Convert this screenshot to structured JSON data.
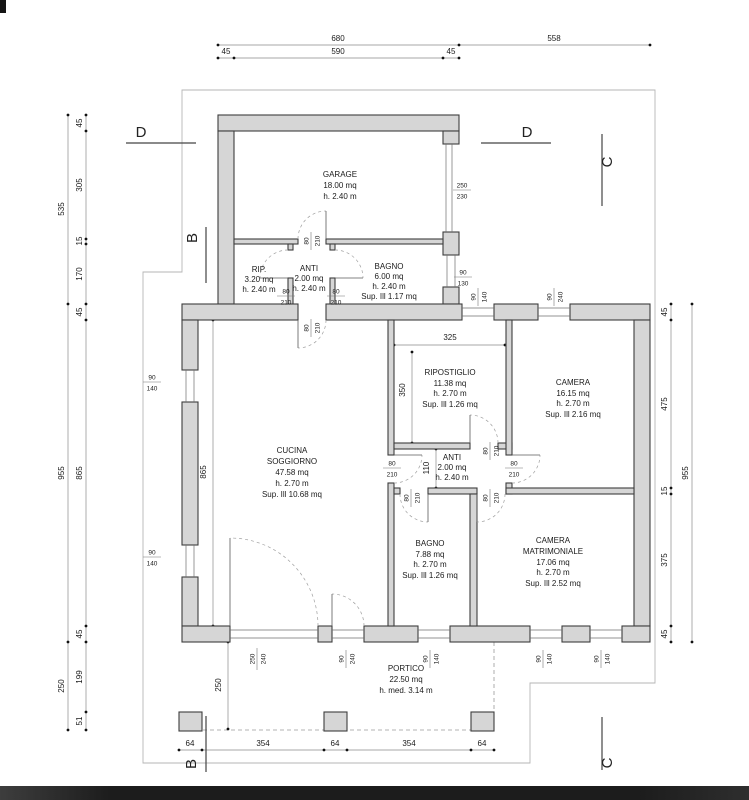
{
  "title": "Floor plan drawing",
  "colors": {
    "background": "#ffffff",
    "wall_fill": "#d6d6d6",
    "wall_stroke": "#3e3e3e",
    "dimension_line": "#8a8a8a",
    "footer_bar": "#1c1c1c"
  },
  "sections": {
    "d": "D",
    "b": "B",
    "c": "C"
  },
  "rooms": {
    "garage": [
      "GARAGE",
      "18.00 mq",
      "h. 2.40 m"
    ],
    "rip": [
      "RIP.",
      "3.20 mq",
      "h. 2.40 m"
    ],
    "anti_top": [
      "ANTI",
      "2.00 mq",
      "h. 2.40 m"
    ],
    "bagno_top": [
      "BAGNO",
      "6.00 mq",
      "h. 2.40 m",
      "Sup. Ill 1.17 mq"
    ],
    "ripostiglio": [
      "RIPOSTIGLIO",
      "11.38 mq",
      "h. 2.70 m",
      "Sup. Ill 1.26 mq"
    ],
    "camera": [
      "CAMERA",
      "16.15 mq",
      "h. 2.70 m",
      "Sup. Ill 2.16 mq"
    ],
    "cucina": [
      "CUCINA",
      "SOGGIORNO",
      "47.58 mq",
      "h. 2.70 m",
      "Sup. Ill 10.68 mq"
    ],
    "anti_mid": [
      "ANTI",
      "2.00 mq",
      "h. 2.40 m"
    ],
    "bagno": [
      "BAGNO",
      "7.88 mq",
      "h. 2.70 m",
      "Sup. Ill 1.26 mq"
    ],
    "camera_matrimoniale": [
      "CAMERA",
      "MATRIMONIALE",
      "17.06 mq",
      "h. 2.70 m",
      "Sup. Ill 2.52 mq"
    ],
    "portico": [
      "PORTICO",
      "22.50 mq",
      "h. med. 3.14 m"
    ]
  },
  "dims": {
    "top": [
      "680",
      "558",
      "45",
      "590",
      "45"
    ],
    "left_outer": [
      "535",
      "955",
      "250"
    ],
    "left_inner": [
      "45",
      "305",
      "15",
      "170",
      "45",
      "865",
      "45",
      "199",
      "51"
    ],
    "right_inner": [
      "45",
      "475",
      "15",
      "375",
      "45"
    ],
    "right_outer": [
      "955"
    ],
    "bottom": [
      "64",
      "354",
      "64",
      "354",
      "64"
    ],
    "interior": {
      "w865": "865",
      "p250": "250",
      "r325": "325",
      "r350": "350",
      "a110": "110"
    }
  },
  "openings": {
    "door": {
      "w": "80",
      "h": "210"
    },
    "garage_door": {
      "w": "250",
      "h": "230"
    },
    "win_90_130": {
      "w": "90",
      "h": "130"
    },
    "win_90_140": {
      "w": "90",
      "h": "140"
    },
    "win_90_240": {
      "w": "90",
      "h": "240"
    },
    "win_250_240": {
      "w": "250",
      "h": "240"
    }
  }
}
